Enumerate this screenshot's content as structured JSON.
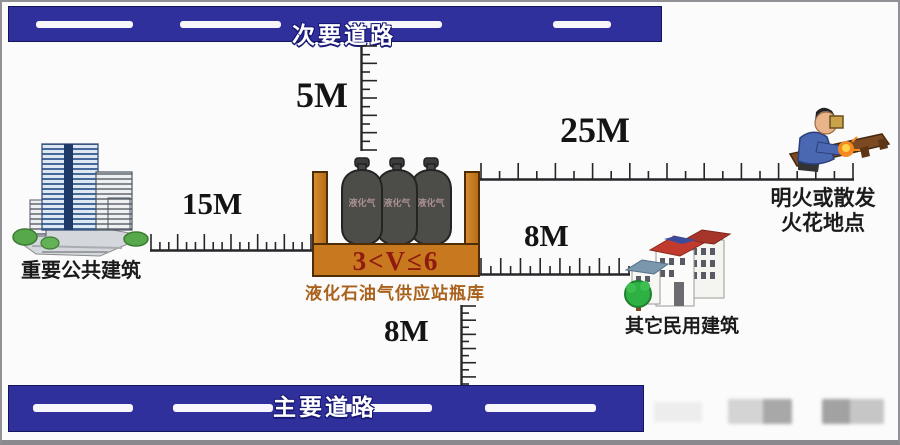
{
  "diagram": {
    "roads": {
      "top": {
        "label": "次要道路"
      },
      "bottom": {
        "label": "主要道路"
      }
    },
    "station": {
      "name": "液化石油气供应站瓶库",
      "volume_label": "3<V≤6",
      "cylinder_label": "液化气"
    },
    "buildings": {
      "public": {
        "label": "重要公共建筑"
      },
      "civil": {
        "label": "其它民用建筑"
      },
      "flame": {
        "label_line1": "明火或散发",
        "label_line2": "火花地点"
      }
    },
    "distances": {
      "to_secondary_road": "5M",
      "to_public_building": "15M",
      "to_flame_source": "25M",
      "to_civil_building": "8M",
      "to_main_road": "8M"
    },
    "colors": {
      "road_blue": "#2f309b",
      "container_orange": "#c8781f",
      "volume_red": "#8f1a0f",
      "station_text": "#a9611b"
    }
  }
}
